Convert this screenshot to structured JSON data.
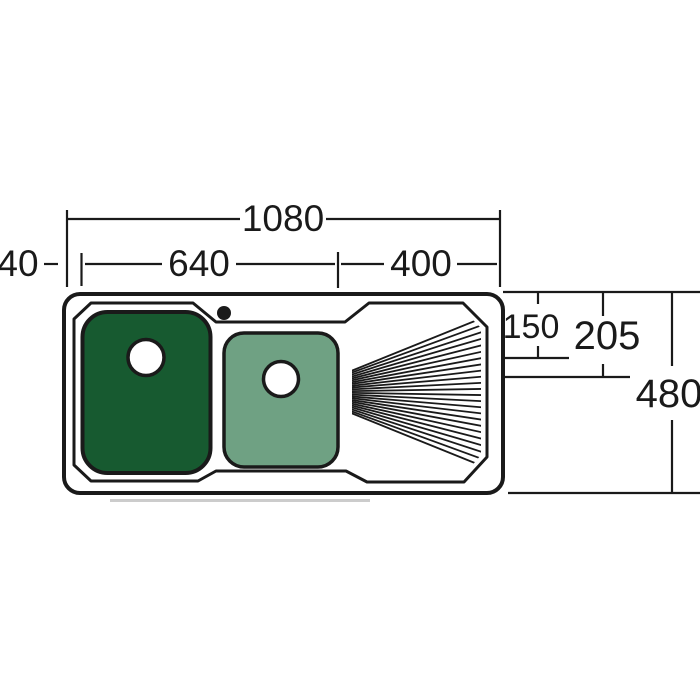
{
  "diagram": {
    "type": "technical-dimension-drawing",
    "subject": "double bowl kitchen sink with right-hand drainer, plan view",
    "units": "mm",
    "labels": {
      "overall_width": "1080",
      "left_edge_offset": "40",
      "bowl_zone_width": "640",
      "drainer_width": "400",
      "drainer_inset_a": "150",
      "drainer_inset_b": "205",
      "overall_depth": "480"
    },
    "colors": {
      "background": "#ffffff",
      "line": "#1a1a1a",
      "main_bowl_fill": "#175a30",
      "half_bowl_fill": "#6fa183",
      "shadow_line": "#cccccc"
    }
  }
}
